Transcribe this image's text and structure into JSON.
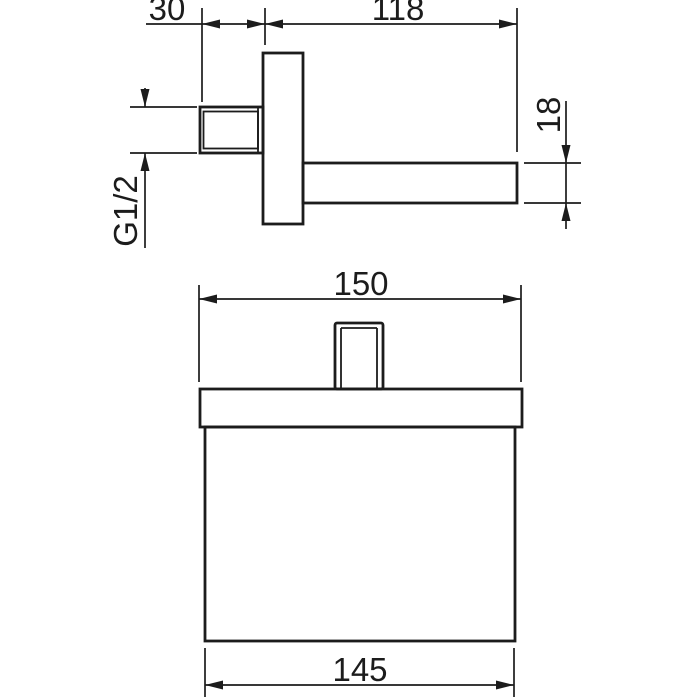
{
  "page": {
    "background_color": "#ffffff",
    "line_color": "#1c1c1c"
  },
  "drawing": {
    "kind": "technical-dimension-drawing",
    "side_view": {
      "labels": {
        "wall_offset": "30",
        "projection": "118",
        "arm_height": "18",
        "thread": "G1/2"
      }
    },
    "front_view": {
      "labels": {
        "plate_width": "150",
        "body_width": "145"
      }
    }
  }
}
